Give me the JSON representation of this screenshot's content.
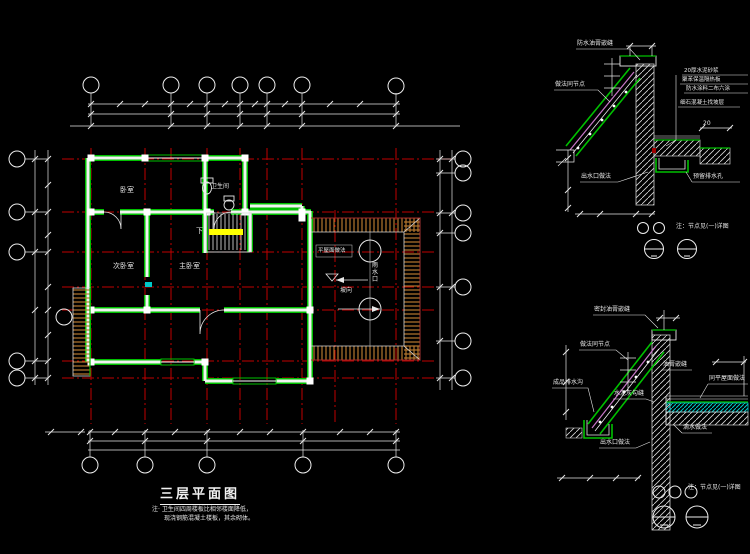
{
  "drawing": {
    "type": "CAD floor plan with construction details",
    "background": "#000000"
  },
  "colors": {
    "grid_red": "#c00000",
    "wall_green": "#00c000",
    "dim_white": "#e6e6e6",
    "magenta": "#c878c8",
    "cyan": "#00c8c8",
    "stair_yellow": "#ffff00",
    "roof_hatch_brown": "#b5772e"
  },
  "plan": {
    "title": "三层平面图",
    "note_line1": "注· 卫生间四周楼板比相邻楼面降低，",
    "note_line2": "现浇钢筋混凝土楼板，其余砌体。",
    "labels": {
      "bedroom_top": "卧室",
      "bathroom": "卫生间",
      "stair_down": "下",
      "room_left": "次卧室",
      "room_right": "主卧室",
      "roof_note": "平屋面做法",
      "slope": "坡向",
      "drain": "雨水口"
    }
  },
  "detail_top": {
    "labels": {
      "seal_top": "防水油膏嵌缝",
      "same_node": "做法同节点",
      "layer_1": "20厚水泥砂浆",
      "layer_2": "聚苯保温隔热板",
      "layer_3": "防水涂料二布六涂",
      "layer_4": "细石混凝土找坡层",
      "dim_20": "20",
      "outlet": "出水口做法",
      "drain_hole": "预留排水孔",
      "note": "注：节点见(一)详图"
    }
  },
  "detail_bottom": {
    "labels": {
      "seal_top": "密封油膏嵌缝",
      "same_node": "做法同节点",
      "gutter": "成品排水沟",
      "pointing": "水泥灰勾缝",
      "seal": "油膏嵌缝",
      "flat_roof": "同平屋面做法",
      "outlet": "出水口做法",
      "drip": "滴水做法",
      "note": "注：节点见(一)详图"
    }
  }
}
